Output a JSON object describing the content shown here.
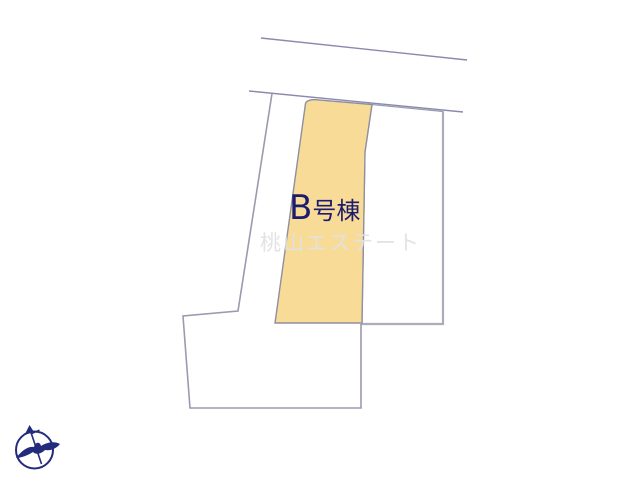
{
  "page": {
    "title": "分譲区画図",
    "background_color": "#ffffff"
  },
  "plot_map": {
    "highlighted_parcel": {
      "label": "B号棟",
      "label_prefix": "B",
      "label_suffix": "号棟",
      "fill_color": "#f7db97",
      "label_color": "#1c1c6e"
    },
    "watermark": {
      "text": "桃山エステート",
      "color": "#e2e2e2"
    },
    "lines": {
      "boundary_color": "#8a8aae",
      "thick_gray_color": "#acacbc"
    },
    "compass": {
      "icon": "north-arrow-bird-in-circle",
      "color": "#232b7c"
    }
  }
}
